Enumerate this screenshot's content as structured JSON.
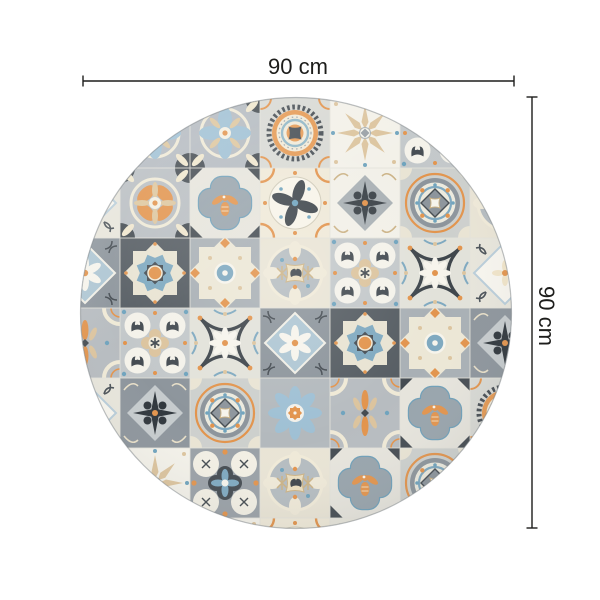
{
  "page": {
    "background_color": "#ffffff"
  },
  "diagram": {
    "type": "product-dimension-diagram",
    "subject": "round-patchwork-tile-rug",
    "line_color": "#1d1d1b",
    "dimensions": {
      "width": {
        "label": "90 cm"
      },
      "height": {
        "label": "90 cm"
      }
    },
    "rug": {
      "shape": "circle",
      "palette": {
        "charcoal": "#454c52",
        "slate": "#8d959c",
        "gray": "#aab1b5",
        "light_gray": "#cfd2cf",
        "cream": "#f0ead8",
        "white": "#f6f4ec",
        "tan": "#dcc49e",
        "orange": "#e2944d",
        "blue": "#7fa9c0",
        "light_blue": "#9fc0d4"
      },
      "tile_grid": [
        [
          "diagwhite",
          "bluepetal",
          "bluepetal",
          "medallion",
          "snowflake",
          "fourrings",
          "diagwhite"
        ],
        [
          "diagwhite",
          "petalcross",
          "quatrefoil",
          "pinwheel",
          "crossstarW",
          "medallion2",
          "circleaster"
        ],
        [
          "diamonddaisy",
          "star16",
          "star8cream",
          "circleaster",
          "fourrings",
          "curvedx",
          "diagwhite"
        ],
        [
          "palmette",
          "fourrings",
          "curvedx",
          "diamonddaisy",
          "star16",
          "star8cream",
          "crossstarS"
        ],
        [
          "diagwhite",
          "crossstarS",
          "medallion2",
          "daisyblue",
          "palmette",
          "quatrefoil",
          "medallion"
        ],
        [
          "crossstarW",
          "snowflake",
          "clover",
          "circleaster",
          "quatrefoil",
          "medallion2",
          "snowflake"
        ],
        [
          "snowflake",
          "diagwhite",
          "snowflake",
          "pinwheel",
          "diagwhite",
          "snowflake",
          "diagwhite"
        ]
      ]
    }
  }
}
